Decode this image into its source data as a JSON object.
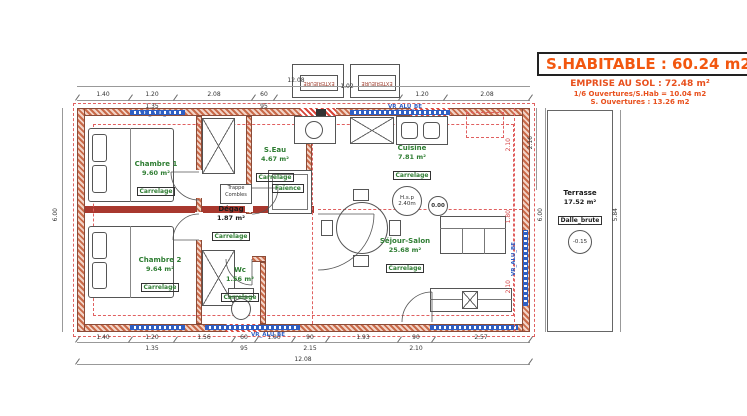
{
  "title_block": {
    "main": "S.HABITABLE : 60.24 m2",
    "emprise": "EMPRISE AU SOL : 72.48 m²",
    "ouvertures_ratio": "1/6 Ouvertures/S.Hab = 10.04 m2",
    "ouvertures": "S. Ouvertures : 13.26 m2"
  },
  "rooms": {
    "chambre1": {
      "name": "Chambre 1",
      "area": "9.60 m²",
      "finish": "Carrelage"
    },
    "chambre2": {
      "name": "Chambre 2",
      "area": "9.64 m²",
      "finish": "Carrelage"
    },
    "degag": {
      "name": "Dégag",
      "area": "1.87 m²",
      "finish": "Carrelage"
    },
    "seau": {
      "name": "S.Eau",
      "area": "4.67 m²",
      "finish": "Carrelage"
    },
    "wc": {
      "name": "Wc",
      "area": "1.56 m²",
      "finish": "Carrelage"
    },
    "cuisine": {
      "name": "Cuisine",
      "area": "7.81 m²",
      "finish": "Carrelage"
    },
    "sejour": {
      "name": "Séjour-Salon",
      "area": "25.68 m²",
      "finish": "Carrelage"
    },
    "terrasse": {
      "name": "Terrasse",
      "area": "17.52 m²",
      "finish": "Dalle_brute"
    }
  },
  "annotations": {
    "trappe": "Trappe",
    "combles": "Combles",
    "faience": "Faïence",
    "hsp_label": "H.s.p",
    "hsp_value": "2.40m",
    "level_main": "0.00",
    "level_terrasse": "-0.15",
    "exterior_box": "EXTERIEURE",
    "window_label": "VR_ALU_BE"
  },
  "dimensions": {
    "top_total": "12.08",
    "top_row1": [
      "1.40",
      "1.20",
      "2.08",
      "60",
      "1.02",
      "1.20",
      "2.08"
    ],
    "top_row2": [
      "1.35",
      "95"
    ],
    "bottom_row1": [
      "1.40",
      "1.20",
      "1.56",
      "60",
      "1.00",
      "90",
      "1.93",
      "90",
      "2.57"
    ],
    "bottom_row2": [
      "1.35",
      "95",
      "2.15",
      "2.10"
    ],
    "bottom_total": "12.08",
    "left_height": "6.00",
    "right_red": [
      "2.10",
      "1.80",
      "2.10"
    ],
    "right_inner": "2.16",
    "right_height": "6.00",
    "terrasse_height": "5.84"
  },
  "colors": {
    "accent": "#f2570f",
    "wall": "#c96a49",
    "dashed_red": "#e06060",
    "window_blue": "#2f5fc4",
    "room_green": "#2e7d32"
  }
}
